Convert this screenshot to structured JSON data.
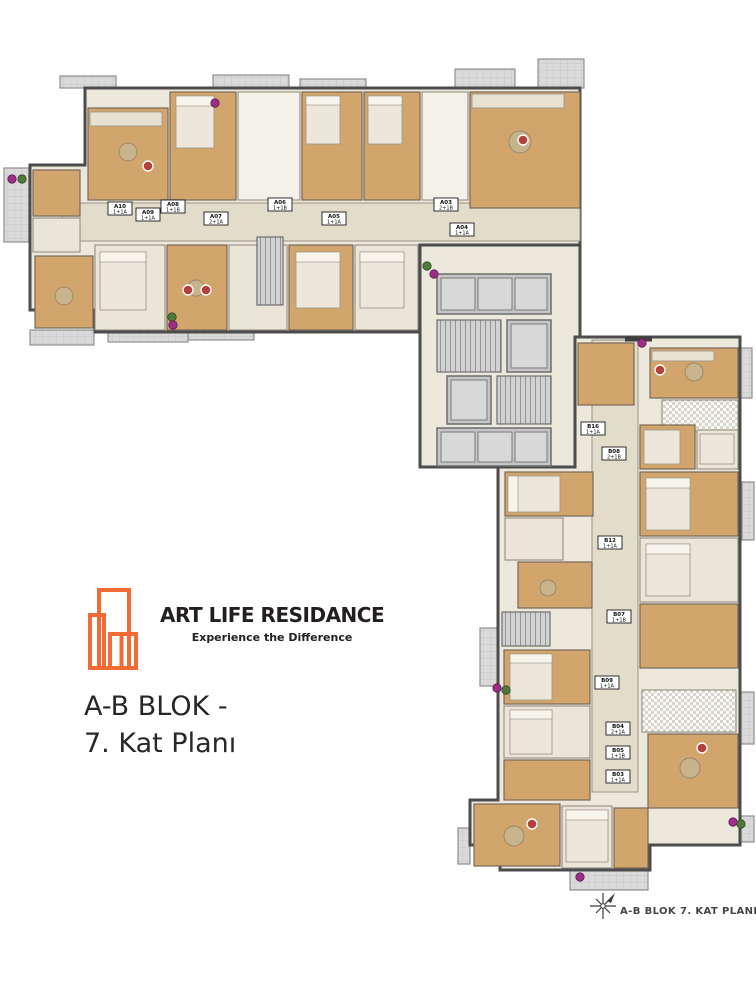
{
  "branding": {
    "title": "ART LIFE RESIDANCE",
    "subtitle": "Experience the Difference"
  },
  "plan_title": {
    "line1": "A-B BLOK -",
    "line2": "7. Kat Planı"
  },
  "compass": {
    "label": "A-B BLOK 7. KAT PLANI"
  },
  "colors": {
    "accent": "#f26b35",
    "wood": "#d1a56b",
    "roomlight": "#eae5d8",
    "slab": "#ece8dc",
    "corridor": "#e2dccb",
    "balcony": "#dadada",
    "wall": "#4c4c4c",
    "elevator": "#c6c6c6",
    "plantm": "#9d2e88",
    "plantg": "#4f7a3a",
    "ink": "#231f20"
  },
  "floorplan": {
    "units": [
      {
        "code": "A10",
        "type": "1+1A",
        "x": 108,
        "y": 202
      },
      {
        "code": "A09",
        "type": "1+1A",
        "x": 136,
        "y": 208
      },
      {
        "code": "A08",
        "type": "1+1B",
        "x": 161,
        "y": 200
      },
      {
        "code": "A07",
        "type": "2+1A",
        "x": 204,
        "y": 212
      },
      {
        "code": "A06",
        "type": "1+1B",
        "x": 268,
        "y": 198
      },
      {
        "code": "A05",
        "type": "1+1A",
        "x": 322,
        "y": 212
      },
      {
        "code": "A03",
        "type": "2+1B",
        "x": 434,
        "y": 198
      },
      {
        "code": "A04",
        "type": "1+1A",
        "x": 450,
        "y": 223
      },
      {
        "code": "B16",
        "type": "1+1A",
        "x": 581,
        "y": 422
      },
      {
        "code": "B08",
        "type": "2+1B",
        "x": 602,
        "y": 447
      },
      {
        "code": "B12",
        "type": "1+1A",
        "x": 598,
        "y": 536
      },
      {
        "code": "B07",
        "type": "1+1B",
        "x": 607,
        "y": 610
      },
      {
        "code": "B09",
        "type": "1+1A",
        "x": 595,
        "y": 676
      },
      {
        "code": "B04",
        "type": "2+1A",
        "x": 606,
        "y": 722
      },
      {
        "code": "B05",
        "type": "1+1B",
        "x": 606,
        "y": 746
      },
      {
        "code": "B03",
        "type": "1+1A",
        "x": 606,
        "y": 770
      }
    ],
    "plants": [
      {
        "x": 215,
        "y": 103,
        "c": "m"
      },
      {
        "x": 12,
        "y": 179,
        "c": "m"
      },
      {
        "x": 22,
        "y": 179,
        "c": "g"
      },
      {
        "x": 172,
        "y": 317,
        "c": "g"
      },
      {
        "x": 173,
        "y": 325,
        "c": "m"
      },
      {
        "x": 642,
        "y": 343,
        "c": "m"
      },
      {
        "x": 497,
        "y": 688,
        "c": "m"
      },
      {
        "x": 506,
        "y": 690,
        "c": "g"
      },
      {
        "x": 733,
        "y": 822,
        "c": "m"
      },
      {
        "x": 741,
        "y": 824,
        "c": "g"
      },
      {
        "x": 580,
        "y": 877,
        "c": "m"
      },
      {
        "x": 427,
        "y": 266,
        "c": "g"
      },
      {
        "x": 434,
        "y": 274,
        "c": "m"
      }
    ]
  }
}
